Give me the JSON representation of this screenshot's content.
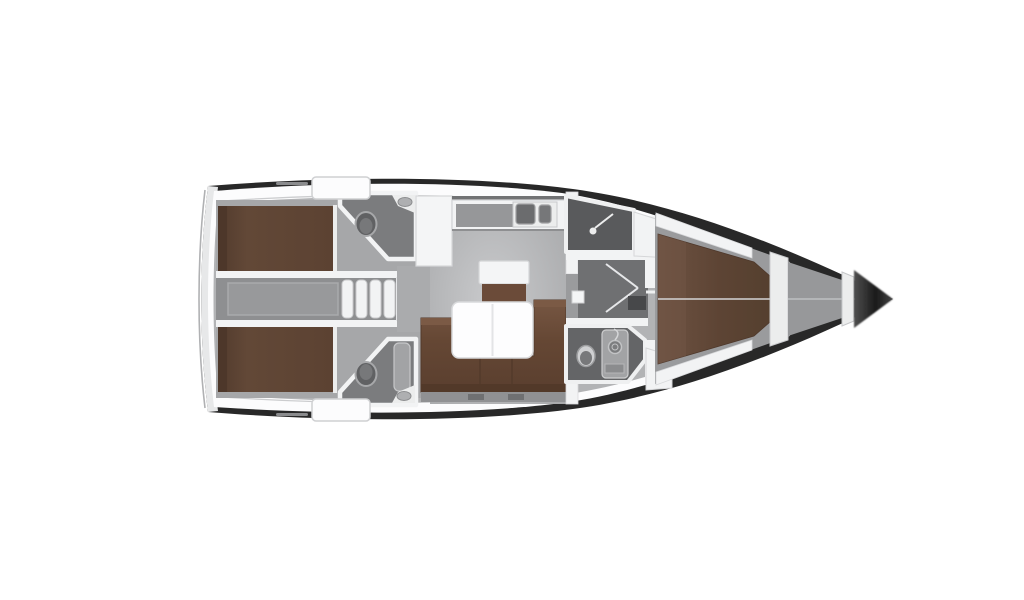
{
  "canvas": {
    "width": 1024,
    "height": 600,
    "background": "#ffffff"
  },
  "palette": {
    "hull_dark": "#282828",
    "deck_white": "#fcfcfd",
    "stern_rim": "#e7e8e9",
    "floor_base": "#b2b3b5",
    "floor_cabin": "#a6a7a9",
    "floor_corridor": "#8e8f91",
    "floor_engine_hatch": "#98999b",
    "floor_salon_entry": "#aaabad",
    "floor_head_aft": "#7b7c7e",
    "floor_shower": "#595a5c",
    "floor_passage": "#6f7072",
    "floor_head_fwd": "#646567",
    "floor_fwd_cabin": "#9a9b9d",
    "floor_anchor": "#97989a",
    "bed_brown": "#5e4434",
    "bed_headboard": "#4d372a",
    "sofa_brown": "#654734",
    "sofa_dark": "#523929",
    "sofa_highlight": "#7b5a45",
    "cabinet_brown": "#6b4b39",
    "cabinet_brown_dark": "#563d2e",
    "wall_white": "#f2f3f4",
    "fixture_white": "#eceded",
    "fixture_light": "#f4f5f6",
    "counter_gray": "#969799",
    "sink_dark": "#6b6c6e",
    "sink_dark2": "#767779",
    "table_white": "#fdfdfe",
    "shelf_gray": "#909193",
    "shelf_box_dark": "#6f7072",
    "line_light": "#e6e7e9",
    "toilet_dark": "#606163",
    "toilet_ring": "#cfd0d2",
    "toilet_inner": "#77787a",
    "column_gray": "#a2a3a5",
    "spiral_gray": "#7c7d7f",
    "locker_dark": "#47484a",
    "backsplash_dark": "#717274",
    "deck_dash": "#8a8b8d"
  },
  "icons": {
    "shower_head": "dot-with-spray-line",
    "toilet": "oval-bowl",
    "sink_basin": "inset-oval",
    "door_swing": "chevron-lines",
    "companionway_steps": "parallel-treads",
    "shower_hose": "spiral-circle"
  }
}
